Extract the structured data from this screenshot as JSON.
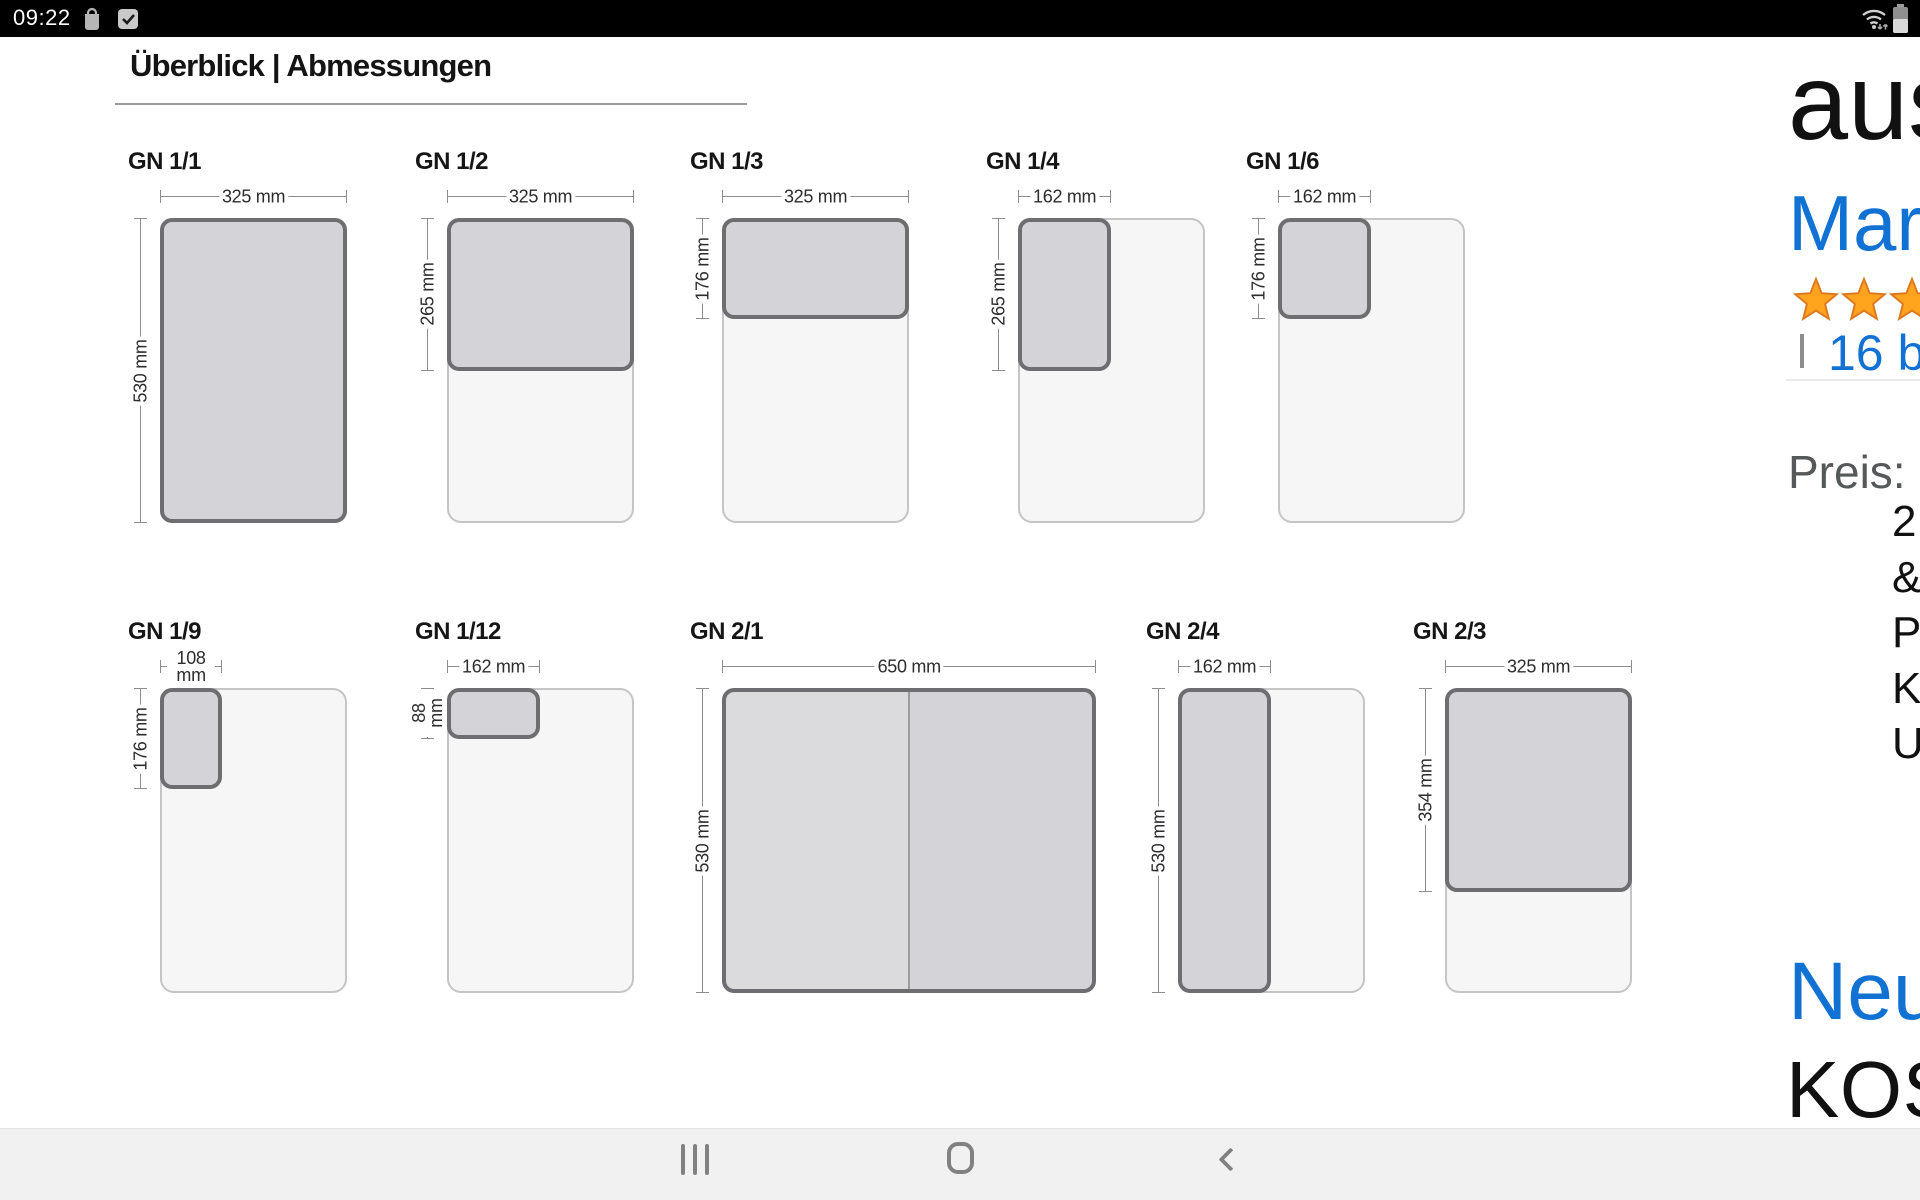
{
  "status_bar": {
    "time": "09:22",
    "left_icons": [
      "shopping-bag",
      "checkbox-checked"
    ],
    "right_icons": [
      "wifi-updown",
      "battery"
    ]
  },
  "diagram": {
    "title": "Überblick | Abmessungen",
    "scale_px_per_mm": 0.576,
    "row_tops": [
      218,
      688
    ],
    "colors": {
      "highlight_fill": "#d4d4d8",
      "highlight_border": "#6e6e72",
      "outer_fill": "#f6f6f7",
      "outer_border": "#c5c5c7",
      "dim_line": "#8c8c8c"
    },
    "panels": [
      {
        "id": "gn-1-1",
        "label": "GN 1/1",
        "row": 0,
        "x": 160,
        "outer_mm": [
          325,
          530
        ],
        "highlight_mm": [
          0,
          0,
          325,
          530
        ],
        "top_dim": {
          "label": "325 mm",
          "span_mm": 325
        },
        "left_dim": {
          "label": "530 mm",
          "span_mm": 530
        }
      },
      {
        "id": "gn-1-2",
        "label": "GN 1/2",
        "row": 0,
        "x": 447,
        "outer_mm": [
          325,
          530
        ],
        "highlight_mm": [
          0,
          0,
          325,
          265
        ],
        "top_dim": {
          "label": "325 mm",
          "span_mm": 325
        },
        "left_dim": {
          "label": "265 mm",
          "span_mm": 265
        }
      },
      {
        "id": "gn-1-3",
        "label": "GN 1/3",
        "row": 0,
        "x": 722,
        "outer_mm": [
          325,
          530
        ],
        "highlight_mm": [
          0,
          0,
          325,
          176
        ],
        "top_dim": {
          "label": "325 mm",
          "span_mm": 325
        },
        "left_dim": {
          "label": "176 mm",
          "span_mm": 176
        }
      },
      {
        "id": "gn-1-4",
        "label": "GN 1/4",
        "row": 0,
        "x": 1018,
        "outer_mm": [
          325,
          530
        ],
        "highlight_mm": [
          0,
          0,
          162,
          265
        ],
        "top_dim": {
          "label": "162 mm",
          "span_mm": 162
        },
        "left_dim": {
          "label": "265 mm",
          "span_mm": 265
        }
      },
      {
        "id": "gn-1-6",
        "label": "GN 1/6",
        "row": 0,
        "x": 1278,
        "outer_mm": [
          325,
          530
        ],
        "highlight_mm": [
          0,
          0,
          162,
          176
        ],
        "top_dim": {
          "label": "162 mm",
          "span_mm": 162
        },
        "left_dim": {
          "label": "176 mm",
          "span_mm": 176
        }
      },
      {
        "id": "gn-1-9",
        "label": "GN 1/9",
        "row": 1,
        "x": 160,
        "outer_mm": [
          325,
          530
        ],
        "highlight_mm": [
          0,
          0,
          108,
          176
        ],
        "top_dim": {
          "label": "108 mm",
          "span_mm": 108,
          "wrap": true
        },
        "left_dim": {
          "label": "176 mm",
          "span_mm": 176
        }
      },
      {
        "id": "gn-1-12",
        "label": "GN 1/12",
        "row": 1,
        "x": 447,
        "outer_mm": [
          325,
          530
        ],
        "highlight_mm": [
          0,
          0,
          162,
          88
        ],
        "top_dim": {
          "label": "162 mm",
          "span_mm": 162
        },
        "left_dim": {
          "label": "88 mm",
          "span_mm": 88,
          "wrap": true
        }
      },
      {
        "id": "gn-2-1",
        "label": "GN 2/1",
        "row": 1,
        "x": 722,
        "outer_mm": [
          650,
          530
        ],
        "highlight_mm": [
          0,
          0,
          650,
          530
        ],
        "top_dim": {
          "label": "650 mm",
          "span_mm": 650
        },
        "left_dim": {
          "label": "530 mm",
          "span_mm": 530
        },
        "divider": true
      },
      {
        "id": "gn-2-4",
        "label": "GN 2/4",
        "row": 1,
        "x": 1178,
        "outer_mm": [
          325,
          530
        ],
        "highlight_mm": [
          0,
          0,
          162,
          530
        ],
        "top_dim": {
          "label": "162 mm",
          "span_mm": 162
        },
        "left_dim": {
          "label": "530 mm",
          "span_mm": 530
        }
      },
      {
        "id": "gn-2-3",
        "label": "GN 2/3",
        "row": 1,
        "x": 1445,
        "outer_mm": [
          325,
          530
        ],
        "highlight_mm": [
          0,
          0,
          325,
          354
        ],
        "top_dim": {
          "label": "325 mm",
          "span_mm": 325
        },
        "left_dim": {
          "label": "354 mm",
          "span_mm": 354
        }
      }
    ]
  },
  "product": {
    "title_partial": "aus",
    "brand_partial": "Mar",
    "rating": {
      "stars_visible": 3,
      "star_color": "#FFA41C",
      "star_border": "#DE7921"
    },
    "separator": "|",
    "reviews_partial": "16 be",
    "price_label": "Preis:",
    "price_partial": "1",
    "detail_line_partials": [
      "2",
      "&",
      "P",
      "K",
      "U"
    ],
    "new_offer_partial": "Neu",
    "shipping_partial": "KOS"
  },
  "nav_bar": {
    "buttons": [
      "recents",
      "home",
      "back"
    ]
  }
}
